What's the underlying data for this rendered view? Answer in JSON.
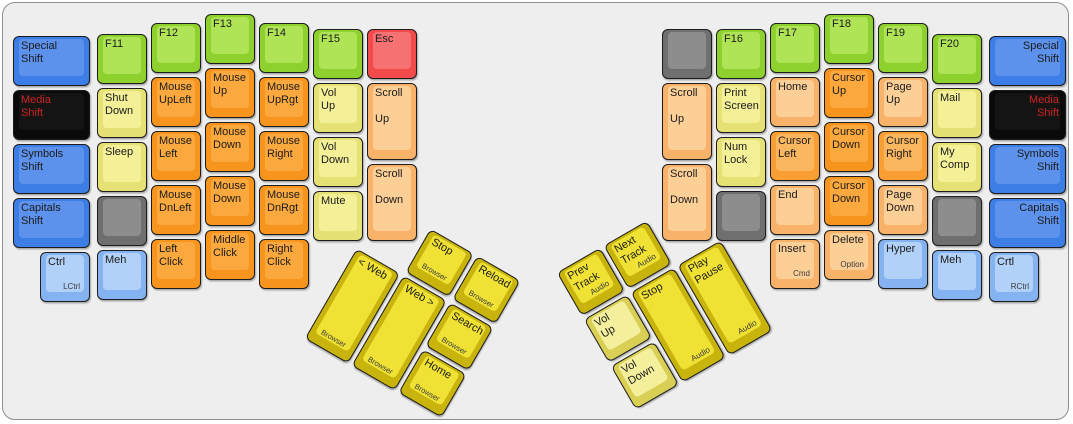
{
  "title": "ErgoDox media / mouse layer keyboard layout",
  "palette": {
    "blue": {
      "b": "#3d7de6",
      "t": "#5d92ec"
    },
    "lblue": {
      "b": "#85b2f0",
      "t": "#b2d1f8"
    },
    "green": {
      "b": "#8ed02e",
      "t": "#b0e457"
    },
    "black": {
      "b": "#0a0a0a",
      "t": "#141414",
      "tc": "#cc2222"
    },
    "pyellow": {
      "b": "#e6e175",
      "t": "#f4f098"
    },
    "gray": {
      "b": "#6f6f6f",
      "t": "#8d8d8d"
    },
    "orange": {
      "b": "#f7941e",
      "t": "#fba93f"
    },
    "orange2": {
      "b": "#f89e33",
      "t": "#fbb660"
    },
    "peach": {
      "b": "#f9b269",
      "t": "#fccf97"
    },
    "red": {
      "b": "#f24b4b",
      "t": "#f67272"
    },
    "gold": {
      "b": "#c8b40d",
      "t": "#efe234"
    },
    "pgold": {
      "b": "#d9cf55",
      "t": "#f4ef9d"
    }
  },
  "keyboard": {
    "case_color": "#eeeeee",
    "unit_px": 54,
    "main_keys": [
      {
        "n": "special-shift-left",
        "l": "Special\nShift",
        "c": "blue",
        "x": 8,
        "y": 31,
        "w": 81
      },
      {
        "n": "media-shift-left",
        "l": "Media\nShift",
        "c": "black",
        "x": 8,
        "y": 85,
        "w": 81
      },
      {
        "n": "symbols-shift-left",
        "l": "Symbols\nShift",
        "c": "blue",
        "x": 8,
        "y": 139,
        "w": 81
      },
      {
        "n": "capitals-shift-left",
        "l": "Capitals\nShift",
        "c": "blue",
        "x": 8,
        "y": 193,
        "w": 81
      },
      {
        "n": "ctrl-left",
        "l": "Ctrl",
        "s": "LCtrl",
        "c": "lblue",
        "x": 35,
        "y": 247
      },
      {
        "n": "f11",
        "l": "F11",
        "c": "green",
        "x": 92,
        "y": 29
      },
      {
        "n": "shut-down",
        "l": "Shut\nDown",
        "c": "pyellow",
        "x": 92,
        "y": 83
      },
      {
        "n": "sleep",
        "l": "Sleep",
        "c": "pyellow",
        "x": 92,
        "y": 137
      },
      {
        "n": "blank-left",
        "l": "",
        "c": "gray",
        "x": 92,
        "y": 191
      },
      {
        "n": "meh-left",
        "l": "Meh",
        "c": "lblue",
        "x": 92,
        "y": 245
      },
      {
        "n": "f12",
        "l": "F12",
        "c": "green",
        "x": 146,
        "y": 18
      },
      {
        "n": "mouse-upleft",
        "l": "Mouse\nUpLeft",
        "c": "orange",
        "x": 146,
        "y": 72
      },
      {
        "n": "mouse-left",
        "l": "Mouse\nLeft",
        "c": "orange",
        "x": 146,
        "y": 126
      },
      {
        "n": "mouse-dnleft",
        "l": "Mouse\nDnLeft",
        "c": "orange",
        "x": 146,
        "y": 180
      },
      {
        "n": "left-click",
        "l": "Left\nClick",
        "c": "orange",
        "x": 146,
        "y": 234
      },
      {
        "n": "f13",
        "l": "F13",
        "c": "green",
        "x": 200,
        "y": 9
      },
      {
        "n": "mouse-up",
        "l": "Mouse\nUp",
        "c": "orange",
        "x": 200,
        "y": 63
      },
      {
        "n": "mouse-down-upper",
        "l": "Mouse\nDown",
        "c": "orange",
        "x": 200,
        "y": 117
      },
      {
        "n": "mouse-down-lower",
        "l": "Mouse\nDown",
        "c": "orange",
        "x": 200,
        "y": 171
      },
      {
        "n": "middle-click",
        "l": "Middle\nClick",
        "c": "orange",
        "x": 200,
        "y": 225
      },
      {
        "n": "f14",
        "l": "F14",
        "c": "green",
        "x": 254,
        "y": 18
      },
      {
        "n": "mouse-uprgt",
        "l": "Mouse\nUpRgt",
        "c": "orange",
        "x": 254,
        "y": 72
      },
      {
        "n": "mouse-right",
        "l": "Mouse\nRight",
        "c": "orange",
        "x": 254,
        "y": 126
      },
      {
        "n": "mouse-dnrgt",
        "l": "Mouse\nDnRgt",
        "c": "orange",
        "x": 254,
        "y": 180
      },
      {
        "n": "right-click",
        "l": "Right\nClick",
        "c": "orange",
        "x": 254,
        "y": 234
      },
      {
        "n": "f15",
        "l": "F15",
        "c": "green",
        "x": 308,
        "y": 24
      },
      {
        "n": "vol-up-left",
        "l": "Vol\nUp",
        "c": "pyellow",
        "x": 308,
        "y": 78
      },
      {
        "n": "vol-down-left",
        "l": "Vol\nDown",
        "c": "pyellow",
        "x": 308,
        "y": 132
      },
      {
        "n": "mute",
        "l": "Mute",
        "c": "pyellow",
        "x": 308,
        "y": 186
      },
      {
        "n": "esc",
        "l": "Esc",
        "c": "red",
        "x": 362,
        "y": 24
      },
      {
        "n": "scroll-up-left",
        "l": "Scroll\n\nUp",
        "c": "peach",
        "x": 362,
        "y": 78,
        "h": 81
      },
      {
        "n": "scroll-down-left",
        "l": "Scroll\n\nDown",
        "c": "peach",
        "x": 362,
        "y": 159,
        "h": 81
      },
      {
        "n": "blank-right-top",
        "l": "",
        "c": "gray",
        "x": 657,
        "y": 24
      },
      {
        "n": "scroll-up-right",
        "l": "Scroll\n\nUp",
        "c": "peach",
        "x": 657,
        "y": 78,
        "h": 81
      },
      {
        "n": "scroll-down-right",
        "l": "Scroll\n\nDown",
        "c": "peach",
        "x": 657,
        "y": 159,
        "h": 81
      },
      {
        "n": "f16",
        "l": "F16",
        "c": "green",
        "x": 711,
        "y": 24
      },
      {
        "n": "print-screen",
        "l": "Print\nScreen",
        "c": "pyellow",
        "x": 711,
        "y": 78
      },
      {
        "n": "num-lock",
        "l": "Num\nLock",
        "c": "pyellow",
        "x": 711,
        "y": 132
      },
      {
        "n": "blank-right-mid",
        "l": "",
        "c": "gray",
        "x": 711,
        "y": 186
      },
      {
        "n": "f17",
        "l": "F17",
        "c": "green",
        "x": 765,
        "y": 18
      },
      {
        "n": "home",
        "l": "Home",
        "c": "peach",
        "x": 765,
        "y": 72
      },
      {
        "n": "cursor-left",
        "l": "Cursor\nLeft",
        "c": "orange2",
        "x": 765,
        "y": 126
      },
      {
        "n": "end",
        "l": "End",
        "c": "peach",
        "x": 765,
        "y": 180
      },
      {
        "n": "insert",
        "l": "Insert",
        "s": "Cmd",
        "c": "peach",
        "x": 765,
        "y": 234
      },
      {
        "n": "f18",
        "l": "F18",
        "c": "green",
        "x": 819,
        "y": 9
      },
      {
        "n": "cursor-up",
        "l": "Cursor\nUp",
        "c": "orange",
        "x": 819,
        "y": 63
      },
      {
        "n": "cursor-down-upper",
        "l": "Cursor\nDown",
        "c": "orange",
        "x": 819,
        "y": 117
      },
      {
        "n": "cursor-down-lower",
        "l": "Cursor\nDown",
        "c": "orange",
        "x": 819,
        "y": 171
      },
      {
        "n": "delete",
        "l": "Delete",
        "s": "Option",
        "c": "peach",
        "x": 819,
        "y": 225
      },
      {
        "n": "f19",
        "l": "F19",
        "c": "green",
        "x": 873,
        "y": 18
      },
      {
        "n": "page-up",
        "l": "Page\nUp",
        "c": "peach",
        "x": 873,
        "y": 72
      },
      {
        "n": "cursor-right",
        "l": "Cursor\nRight",
        "c": "orange2",
        "x": 873,
        "y": 126
      },
      {
        "n": "page-down",
        "l": "Page\nDown",
        "c": "peach",
        "x": 873,
        "y": 180
      },
      {
        "n": "hyper",
        "l": "Hyper",
        "c": "lblue",
        "x": 873,
        "y": 234
      },
      {
        "n": "f20",
        "l": "F20",
        "c": "green",
        "x": 927,
        "y": 29
      },
      {
        "n": "mail",
        "l": "Mail",
        "c": "pyellow",
        "x": 927,
        "y": 83
      },
      {
        "n": "my-comp",
        "l": "My\nComp",
        "c": "pyellow",
        "x": 927,
        "y": 137
      },
      {
        "n": "blank-right-bottom",
        "l": "",
        "c": "gray",
        "x": 927,
        "y": 191
      },
      {
        "n": "meh-right",
        "l": "Meh",
        "c": "lblue",
        "x": 927,
        "y": 245
      },
      {
        "n": "special-shift-right",
        "l": "Special\nShift",
        "c": "blue",
        "x": 984,
        "y": 31,
        "w": 81,
        "a": "r"
      },
      {
        "n": "media-shift-right",
        "l": "Media\nShift",
        "c": "black",
        "x": 984,
        "y": 85,
        "w": 81,
        "a": "r"
      },
      {
        "n": "symbols-shift-right",
        "l": "Symbols\nShift",
        "c": "blue",
        "x": 984,
        "y": 139,
        "w": 81,
        "a": "r"
      },
      {
        "n": "capitals-shift-right",
        "l": "Capitals\nShift",
        "c": "blue",
        "x": 984,
        "y": 193,
        "w": 81,
        "a": "r"
      },
      {
        "n": "crtl-right",
        "l": "Crtl",
        "s": "RCtrl",
        "c": "lblue",
        "x": 984,
        "y": 247
      }
    ],
    "left_thumb": {
      "x": 380,
      "y": 196,
      "angle": 30,
      "keys": [
        {
          "n": "browser-stop",
          "l": "Stop",
          "s": "Browser",
          "sp": "c",
          "c": "gold",
          "x": 54,
          "y": 0
        },
        {
          "n": "browser-reload",
          "l": "Reload",
          "s": "Browser",
          "sp": "c",
          "c": "gold",
          "x": 108,
          "y": 0
        },
        {
          "n": "browser-back",
          "l": "< Web",
          "s": "Browser",
          "sp": "c",
          "c": "gold",
          "x": 0,
          "y": 54,
          "h": 108
        },
        {
          "n": "browser-forward",
          "l": "Web >",
          "s": "Browser",
          "sp": "c",
          "c": "gold",
          "x": 54,
          "y": 54,
          "h": 108
        },
        {
          "n": "browser-search",
          "l": "Search",
          "s": "Browser",
          "sp": "c",
          "c": "gold",
          "x": 108,
          "y": 54
        },
        {
          "n": "browser-home",
          "l": "Home",
          "s": "Browser",
          "sp": "c",
          "c": "gold",
          "x": 108,
          "y": 108
        }
      ]
    },
    "right_thumb": {
      "x": 551,
      "y": 269,
      "angle": -30,
      "keys": [
        {
          "n": "prev-track",
          "l": "Prev\nTrack",
          "s": "Audio",
          "sp": "r",
          "c": "gold",
          "x": 0,
          "y": 0
        },
        {
          "n": "next-track",
          "l": "Next\nTrack",
          "s": "Audio",
          "sp": "r",
          "c": "gold",
          "x": 54,
          "y": 0
        },
        {
          "n": "vol-up-thumb",
          "l": "Vol\nUp",
          "c": "pgold",
          "x": 0,
          "y": 54
        },
        {
          "n": "audio-stop",
          "l": "Stop",
          "s": "Audio",
          "sp": "r",
          "c": "gold",
          "x": 54,
          "y": 54,
          "h": 108
        },
        {
          "n": "play-pause",
          "l": "Play\nPause",
          "s": "Audio",
          "sp": "r",
          "c": "gold",
          "x": 108,
          "y": 54,
          "h": 108
        },
        {
          "n": "vol-down-thumb",
          "l": "Vol\nDown",
          "c": "pgold",
          "x": 0,
          "y": 108
        }
      ]
    }
  }
}
